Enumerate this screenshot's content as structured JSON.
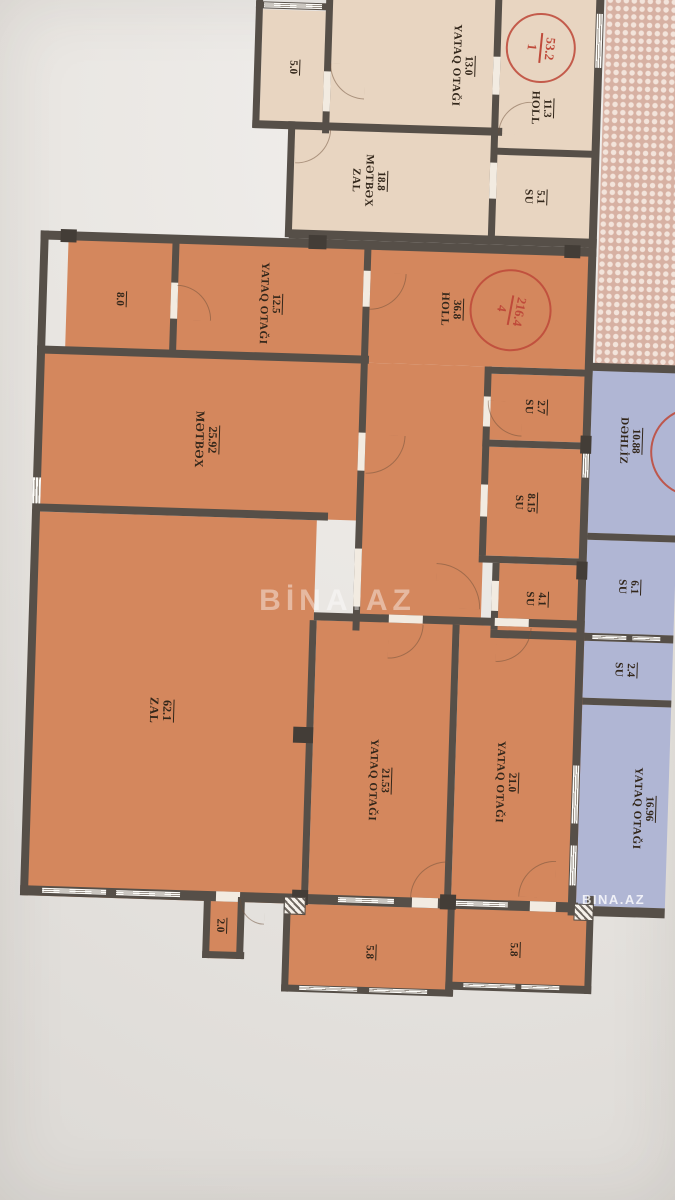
{
  "watermark": {
    "center": "BİNA.AZ",
    "corner": "BINA.AZ"
  },
  "stamps": {
    "apt1": {
      "number": "1",
      "total_area": "53.2"
    },
    "apt4": {
      "number": "4",
      "total_area": "216.4"
    }
  },
  "apt1": {
    "balcony": {
      "area": "5.0"
    },
    "bedroom": {
      "name": "YATAQ OTAĞI",
      "area": "13.0"
    },
    "zal_metbex": {
      "name1": "ZAL",
      "name2": "MƏTBƏX",
      "area": "18.8"
    },
    "holl": {
      "name": "HOLL",
      "area": "11.3"
    },
    "su": {
      "name": "SU",
      "area": "5.1"
    }
  },
  "apt4": {
    "balcony_top": {
      "area": "8.0"
    },
    "bedroom1": {
      "name": "YATAQ OTAĞI",
      "area": "12.5"
    },
    "holl": {
      "name": "HOLL",
      "area": "36.8"
    },
    "metbex": {
      "name": "MƏTBƏX",
      "area": "25.92"
    },
    "su1": {
      "name": "SU",
      "area": "2.7"
    },
    "su2": {
      "name": "SU",
      "area": "8.15"
    },
    "su3": {
      "name": "SU",
      "area": "4.1"
    },
    "zal": {
      "name": "ZAL",
      "area": "62.1"
    },
    "bedroom2": {
      "name": "YATAQ OTAĞI",
      "area": "21.53"
    },
    "bedroom3": {
      "name": "YATAQ OTAĞI",
      "area": "21.0"
    },
    "balcony_left": {
      "area": "2.0"
    },
    "balcony_bottom1": {
      "area": "5.8"
    },
    "balcony_bottom2": {
      "area": "5.8"
    }
  },
  "neighbor": {
    "dehliz": {
      "name": "DƏHLİZ",
      "area": "10.88"
    },
    "su1": {
      "name": "SU",
      "area": "6.1"
    },
    "su2": {
      "name": "SU",
      "area": "2.4"
    },
    "bedroom": {
      "name": "YATAQ OTAĞI",
      "area": "16.96"
    }
  },
  "colors": {
    "apt1_fill": "#e8d5c1",
    "apt4_fill": "#d4875d",
    "neighbor_fill": "#b0b6d4",
    "hatch_fill": "#d7b1a3",
    "wall": "#564f48",
    "stamp_red": "#bf4a3a",
    "paper": "#eae7e3",
    "text": "#32261a"
  }
}
